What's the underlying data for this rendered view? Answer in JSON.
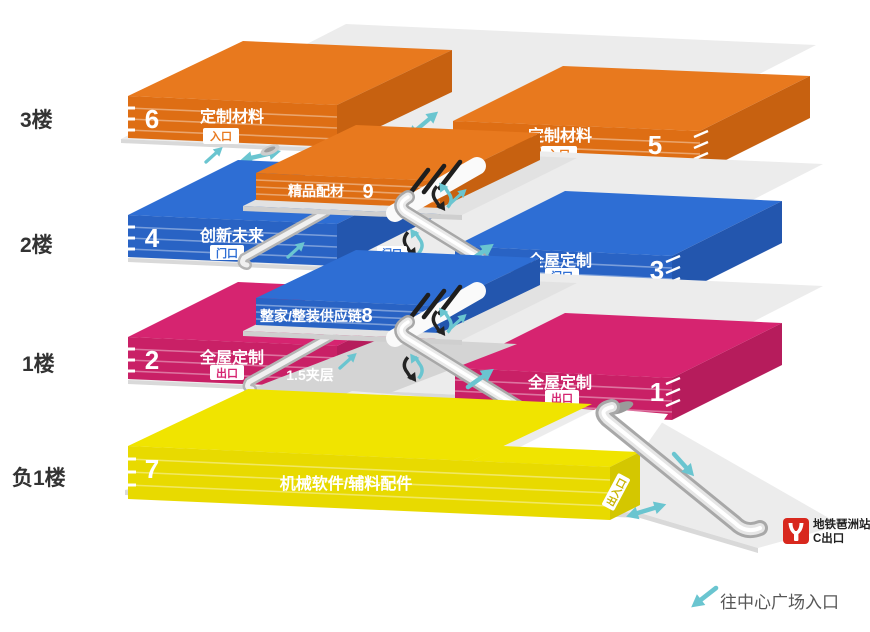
{
  "floors": {
    "f3": "3楼",
    "f2": "2楼",
    "f1": "1楼",
    "fb1": "负1楼"
  },
  "halls": {
    "h6": {
      "num": "6",
      "name": "定制材料",
      "door": "入口"
    },
    "h5": {
      "num": "5",
      "name": "定制材料",
      "door": "入口"
    },
    "h9": {
      "num": "9",
      "name": "精品配材"
    },
    "h4": {
      "num": "4",
      "name": "创新未来",
      "door": "门口"
    },
    "h3": {
      "num": "3",
      "name": "全屋定制",
      "door": "门口"
    },
    "h8": {
      "num": "8",
      "name": "整家/整装供应链"
    },
    "h2": {
      "num": "2",
      "name": "全屋定制",
      "door": "出口"
    },
    "h1": {
      "num": "1",
      "name": "全屋定制",
      "door": "出口"
    },
    "h7": {
      "num": "7",
      "name": "机械软件/辅料配件",
      "door": "出入口"
    }
  },
  "labels": {
    "entrance_mid": "入口",
    "gate_f2_right": "门口",
    "mezzanine": "1.5夹层",
    "plaza": "往中心广场入口"
  },
  "metro": {
    "station": "地铁琶洲站",
    "exit": "C出口"
  },
  "colors": {
    "orange": "#E8791E",
    "blue": "#2E6ED4",
    "pink": "#D62470",
    "yellow": "#F0E400",
    "teal": "#6AC5D0",
    "metro_red": "#D8281E"
  }
}
